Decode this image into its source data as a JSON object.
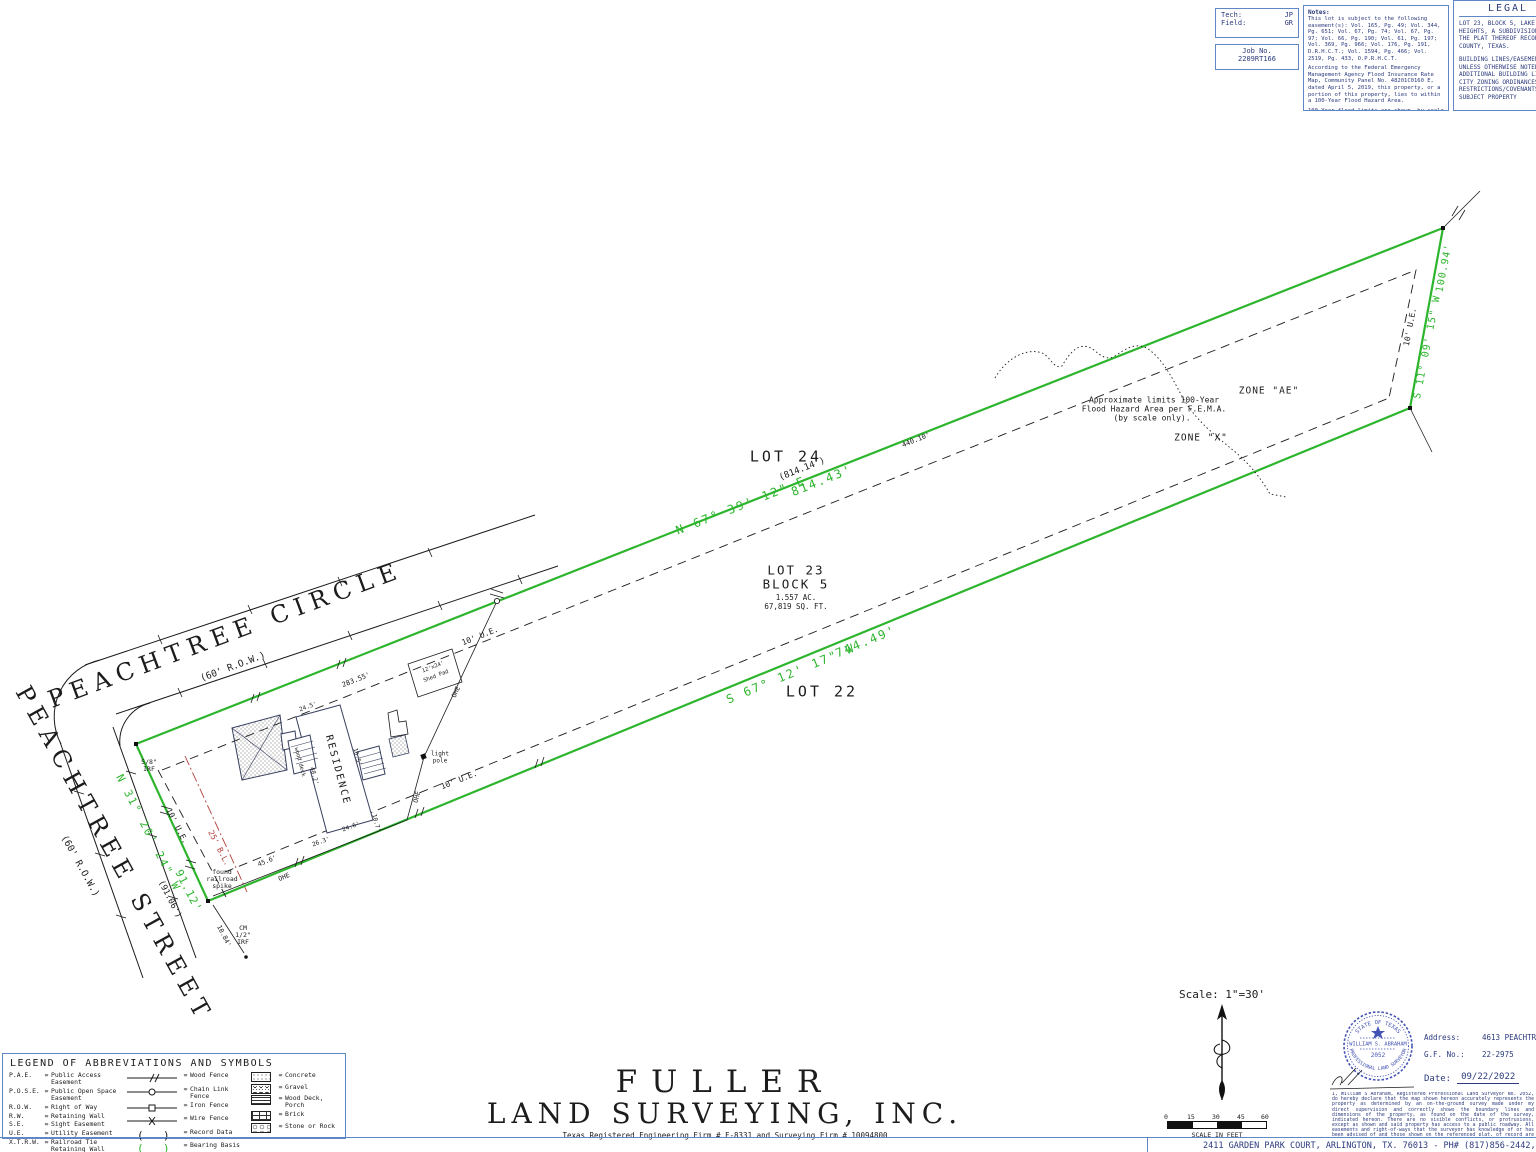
{
  "colors": {
    "ink": "#1c1c1c",
    "green": "#2db52d",
    "blue": "#5f86c5",
    "navy": "#2b3a7d",
    "red": "#b04038",
    "stamp": "#4353b4"
  },
  "header": {
    "tech_box": {
      "tech_label": "Tech:",
      "tech_value": "JP",
      "field_label": "Field:",
      "field_value": "GR"
    },
    "job_box": {
      "label": "Job No.",
      "value": "2209RT166"
    },
    "notes": {
      "title": "Notes:",
      "para1": "This lot is subject to the following easement(s): Vol. 165, Pg. 49; Vol. 344, Pg. 651; Vol. 67, Pg. 74; Vol. 67, Pg. 97; Vol. 66, Pg. 190; Vol. 61, Pg. 197; Vol. 369, Pg. 966; Vol. 176, Pg. 191, D.R.H.C.T.; Vol. 1594, Pg. 466; Vol. 2519, Pg. 433, O.P.R.H.C.T.",
      "para2": "According to the Federal Emergency Management Agency Flood Insurance Rate Map, Community Panel No. 48201C0160 E, dated April 5, 2019, this property, or a portion of this property, lies to within a 100-Year Flood Hazard Area.",
      "para3": "100-Year flood limits are shown, by scale only, to make all parties aware that there are possible flood issues on or near this property. Fuller Land Surveying, Inc. assumes no liability for the accuracy of the flood map or maps."
    },
    "legal": {
      "title": "LEGAL",
      "block1": [
        "LOT 23, BLOCK 5, LAKE GARDEN",
        "HEIGHTS, A SUBDIVISION IN",
        "THE PLAT THEREOF RECORDED",
        "COUNTY, TEXAS."
      ],
      "block2": [
        "BUILDING LINES/EASEMENTS",
        "UNLESS OTHERWISE NOTED",
        "ADDITIONAL BUILDING LINES",
        "CITY ZONING ORDINANCES",
        "RESTRICTIONS/COVENANTS",
        "SUBJECT PROPERTY"
      ]
    }
  },
  "legend": {
    "title": "LEGEND OF ABBREVIATIONS AND SYMBOLS",
    "abbrevs": [
      {
        "abbr": "P.A.E.",
        "def": "Public Access Easement"
      },
      {
        "abbr": "P.O.S.E.",
        "def": "Public Open Space Easement"
      },
      {
        "abbr": "R.O.W.",
        "def": "Right of Way"
      },
      {
        "abbr": "R.W.",
        "def": "Retaining Wall"
      },
      {
        "abbr": "S.E.",
        "def": "Sight Easement"
      },
      {
        "abbr": "U.E.",
        "def": "Utility Easement"
      },
      {
        "abbr": "X.T.R.W.",
        "def": "Railroad Tie Retaining Wall"
      },
      {
        "abbr": "O.H.E.",
        "def": "Overhead Electric"
      }
    ],
    "lines": [
      {
        "symbol": "wood-fence",
        "def": "Wood Fence"
      },
      {
        "symbol": "chain-link-fence",
        "def": "Chain Link Fence"
      },
      {
        "symbol": "iron-fence",
        "def": "Iron Fence"
      },
      {
        "symbol": "wire-fence",
        "def": "Wire Fence"
      },
      {
        "symbol": "record-data",
        "def": "Record Data"
      },
      {
        "symbol": "bearing-basis",
        "def": "Bearing Basis"
      },
      {
        "symbol": "covered-porch",
        "def": "Covered porch, Entrance or Deck"
      }
    ],
    "fills": [
      {
        "symbol": "concrete",
        "def": "Concrete"
      },
      {
        "symbol": "gravel",
        "def": "Gravel"
      },
      {
        "symbol": "wood-deck",
        "def": "Wood Deck, Porch"
      },
      {
        "symbol": "brick",
        "def": "Brick"
      },
      {
        "symbol": "stone",
        "def": "Stone or Rock"
      }
    ]
  },
  "title_block": {
    "company_line1": "FULLER",
    "company_line2": "LAND SURVEYING, INC.",
    "registration": "Texas Registered Engineering Firm # F-8331 and Surveying Firm # 10094800",
    "address_bar": "2411 GARDEN PARK COURT, ARLINGTON, TX. 76013 - PH# (817)856-2442, FAX# (817)4"
  },
  "certification": {
    "scale_label": "Scale: 1\"=30'",
    "scale_bar_ticks": [
      "0",
      "15",
      "30",
      "45",
      "60"
    ],
    "scale_bar_caption": "SCALE IN FEET",
    "address_label": "Address:",
    "address_value": "4613 PEACHTREE S",
    "gf_label": "G.F. No.:",
    "gf_value": "22-2975",
    "date_label": "Date:",
    "date_value": "09/22/2022",
    "stamp": {
      "top": "STATE OF TEXAS",
      "name": "WILLIAM S. ABRAHAM",
      "number": "2052",
      "bottom": "PROFESSIONAL LAND SURVEYOR"
    },
    "statement": "I, William S Abraham, Registered Professional Land Surveyor No. 2052, do hereby declare that the map shown hereon accurately represents the property as determined by an on-the-ground survey made under my direct supervision and correctly shows the boundary lines and dimensions of the property, as found on the date of the survey, indicated hereon. There are no visible conflicts, or protrusions, except as shown and said property has access to a public roadway. All easements and right-of-ways that the surveyor has knowledge of or has been advised of and those shown on the referenced plat, of record are shown or noted hereon. This survey is for the exclusive use of this company, the mortgage company and the purchaser."
  },
  "drawing": {
    "labels": [
      {
        "t": "PEACHTREE CIRCLE",
        "x": 226,
        "y": 636,
        "r": -20.5,
        "s": 24,
        "ls": 7,
        "f": "s",
        "n": "street-name-peachtree-circle"
      },
      {
        "t": "(60' R.O.W.)",
        "x": 233,
        "y": 667,
        "r": -20.5,
        "s": 9.5,
        "n": "peachtree-circle-row-label"
      },
      {
        "t": "PEACHTREE STREET",
        "x": 113,
        "y": 855,
        "r": 61,
        "s": 24,
        "ls": 7,
        "f": "s",
        "n": "street-name-peachtree-street"
      },
      {
        "t": "(60' R.O.W.)",
        "x": 80,
        "y": 866,
        "r": 61,
        "s": 9.5,
        "n": "peachtree-street-row-label"
      },
      {
        "t": "LOT 24",
        "x": 786,
        "y": 457,
        "s": 15,
        "ls": 3,
        "n": "lot-24-label"
      },
      {
        "t": "LOT 22",
        "x": 822,
        "y": 692,
        "s": 15,
        "ls": 3,
        "n": "lot-22-label"
      },
      {
        "t": "LOT 23",
        "x": 796,
        "y": 571,
        "s": 12.5,
        "ls": 2,
        "n": "lot-23-label"
      },
      {
        "t": "BLOCK 5",
        "x": 796,
        "y": 585,
        "s": 12.5,
        "ls": 2,
        "n": "block-5-label"
      },
      {
        "t": "1.557 AC.",
        "x": 796,
        "y": 598,
        "s": 7.5,
        "n": "acreage-label"
      },
      {
        "t": "67,819 SQ. FT.",
        "x": 796,
        "y": 607,
        "s": 7.5,
        "n": "square-footage-label"
      },
      {
        "t": "(814.14')",
        "x": 802,
        "y": 469,
        "r": -21.5,
        "s": 9,
        "n": "record-distance-north-line"
      },
      {
        "t": "N 67° 39' 12\" E",
        "x": 741,
        "y": 506,
        "r": -21.5,
        "s": 12,
        "ls": 2,
        "c": "g",
        "n": "bearing-north-line"
      },
      {
        "t": "814.43'",
        "x": 822,
        "y": 481,
        "r": -21.5,
        "s": 12,
        "ls": 2,
        "c": "g",
        "n": "distance-north-line"
      },
      {
        "t": "S 67° 12' 17\" W",
        "x": 791,
        "y": 674,
        "r": -22.5,
        "s": 12,
        "ls": 2,
        "c": "g",
        "n": "bearing-south-line"
      },
      {
        "t": "744.49'",
        "x": 866,
        "y": 642,
        "r": -22.5,
        "s": 12,
        "ls": 2,
        "c": "g",
        "n": "distance-south-line"
      },
      {
        "t": "S 11° 09' 15\" W",
        "x": 1427,
        "y": 347,
        "r": -79,
        "s": 10,
        "ls": 1,
        "c": "g",
        "n": "bearing-east-line"
      },
      {
        "t": "100.94'",
        "x": 1444,
        "y": 268,
        "r": -79,
        "s": 10,
        "ls": 1,
        "c": "g",
        "n": "distance-east-line"
      },
      {
        "t": "N 31° 20' 24\" W",
        "x": 148,
        "y": 833,
        "r": 63,
        "s": 11,
        "ls": 2,
        "c": "g",
        "n": "bearing-west-line"
      },
      {
        "t": "91.12'",
        "x": 188,
        "y": 891,
        "r": 63,
        "s": 11,
        "ls": 1,
        "c": "g",
        "n": "distance-west-line"
      },
      {
        "t": "(91.06')",
        "x": 170,
        "y": 899,
        "r": 63,
        "s": 8.5,
        "n": "record-distance-west-line"
      },
      {
        "t": "10' U.E.",
        "x": 480,
        "y": 636,
        "r": -21.5,
        "s": 8,
        "n": "utility-easement-label-north"
      },
      {
        "t": "10' U.E.",
        "x": 459,
        "y": 780,
        "r": -21.5,
        "s": 8,
        "n": "utility-easement-label-south"
      },
      {
        "t": "10' U.E.",
        "x": 1410,
        "y": 327,
        "r": -79,
        "s": 8,
        "n": "utility-easement-label-east"
      },
      {
        "t": "10' U.E.",
        "x": 177,
        "y": 826,
        "r": 63,
        "s": 8,
        "n": "utility-easement-label-west"
      },
      {
        "t": "25' B.L.",
        "x": 219,
        "y": 848,
        "r": 63,
        "s": 8,
        "c": "r",
        "n": "building-line-label"
      },
      {
        "t": "283.55'",
        "x": 356,
        "y": 680,
        "r": -21.5,
        "s": 7,
        "n": "dimension-283"
      },
      {
        "t": "440.10'",
        "x": 916,
        "y": 440,
        "r": -21.5,
        "s": 7,
        "n": "dimension-440"
      },
      {
        "t": "ZONE \"AE\"",
        "x": 1269,
        "y": 391,
        "s": 9.5,
        "ls": 1,
        "n": "zone-ae-label"
      },
      {
        "t": "ZONE \"X\"",
        "x": 1201,
        "y": 438,
        "s": 9.5,
        "ls": 1,
        "n": "zone-x-label"
      },
      {
        "t": "Approximate limits 100-Year",
        "x": 1154,
        "y": 400,
        "s": 8,
        "n": "flood-note-line1"
      },
      {
        "t": "Flood Hazard Area per F.E.M.A.",
        "x": 1154,
        "y": 409,
        "s": 8,
        "n": "flood-note-line2"
      },
      {
        "t": "(by scale only).",
        "x": 1152,
        "y": 418,
        "s": 8,
        "n": "flood-note-line3"
      },
      {
        "t": "RESIDENCE",
        "x": 338,
        "y": 770,
        "r": 75,
        "s": 10,
        "ls": 2,
        "n": "residence-label"
      },
      {
        "t": "light",
        "x": 440,
        "y": 754,
        "s": 6,
        "n": "light-pole-label-1"
      },
      {
        "t": "pole",
        "x": 440,
        "y": 761,
        "s": 6,
        "n": "light-pole-label-2"
      },
      {
        "t": "wood deck",
        "x": 300,
        "y": 762,
        "r": 75,
        "s": 5.5,
        "n": "wood-deck-label"
      },
      {
        "t": "found",
        "x": 222,
        "y": 872,
        "s": 6.5,
        "n": "found-spike-label-1"
      },
      {
        "t": "railroad",
        "x": 222,
        "y": 879,
        "s": 6.5,
        "n": "found-spike-label-2"
      },
      {
        "t": "spike",
        "x": 222,
        "y": 886,
        "s": 6.5,
        "n": "found-spike-label-3"
      },
      {
        "t": "5/8\"",
        "x": 149,
        "y": 762,
        "s": 6.5,
        "n": "irf-label-1"
      },
      {
        "t": "IRF",
        "x": 149,
        "y": 769,
        "s": 6.5,
        "n": "irf-label-2"
      },
      {
        "t": "CM",
        "x": 243,
        "y": 928,
        "s": 6.5,
        "n": "cm-irf-label-1"
      },
      {
        "t": "1/2\"",
        "x": 243,
        "y": 935,
        "s": 6.5,
        "n": "cm-irf-label-2"
      },
      {
        "t": "IRF",
        "x": 243,
        "y": 942,
        "s": 6.5,
        "n": "cm-irf-label-3"
      },
      {
        "t": "10.84'",
        "x": 224,
        "y": 936,
        "r": 63,
        "s": 6.5,
        "n": "dimension-1084"
      },
      {
        "t": "OHE",
        "x": 456,
        "y": 692,
        "r": -65,
        "s": 6.5,
        "n": "ohe-label-1"
      },
      {
        "t": "OHE",
        "x": 417,
        "y": 797,
        "r": -75,
        "s": 6.5,
        "n": "ohe-label-2"
      },
      {
        "t": "OHE",
        "x": 284,
        "y": 877,
        "r": -22.5,
        "s": 6.5,
        "n": "ohe-label-3"
      },
      {
        "t": "45.6'",
        "x": 267,
        "y": 861,
        "r": -22.5,
        "s": 6.5,
        "n": "dimension-456"
      },
      {
        "t": "12'x24'",
        "x": 433,
        "y": 667,
        "r": -21.5,
        "s": 5.5,
        "n": "shed-label-1"
      },
      {
        "t": "Shed Pad",
        "x": 436,
        "y": 676,
        "r": -21.5,
        "s": 5.5,
        "n": "shed-label-2"
      },
      {
        "t": "24.5'",
        "x": 308,
        "y": 707,
        "r": -20,
        "s": 6,
        "n": "dimension-245"
      },
      {
        "t": "48.2'",
        "x": 314,
        "y": 776,
        "r": 75,
        "s": 6,
        "n": "dimension-482"
      },
      {
        "t": "16.5'",
        "x": 357,
        "y": 757,
        "r": 75,
        "s": 6,
        "n": "dimension-165"
      },
      {
        "t": "24.6'",
        "x": 351,
        "y": 827,
        "r": -20,
        "s": 6,
        "n": "dimension-246"
      },
      {
        "t": "10.7'",
        "x": 376,
        "y": 823,
        "r": 75,
        "s": 6,
        "n": "dimension-107"
      },
      {
        "t": "26.3'",
        "x": 321,
        "y": 842,
        "r": -20,
        "s": 6,
        "n": "dimension-263"
      }
    ]
  }
}
